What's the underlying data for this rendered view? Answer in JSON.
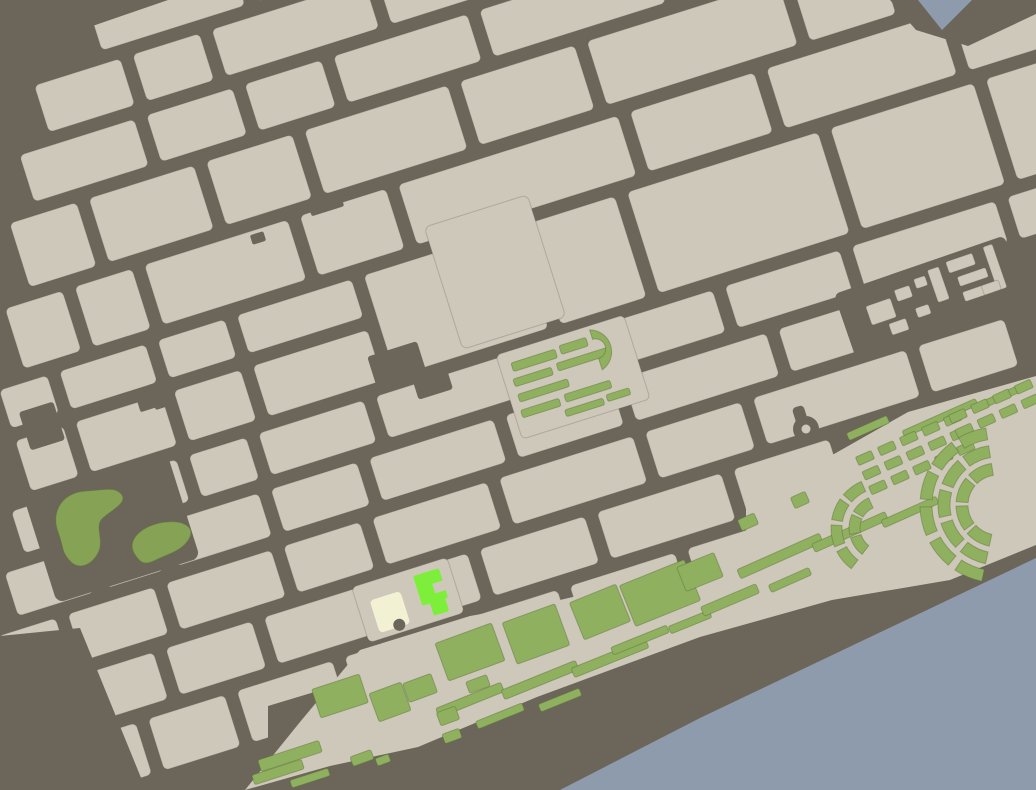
{
  "map": {
    "colors": {
      "ground": "#6C665A",
      "water": "#8E9BAC",
      "block": "#CEC8BB",
      "lawn": "#8FB05F",
      "park": "#86A254",
      "highlight_building": "#7DEF3A",
      "cream_building": "#F2F1D3"
    },
    "features": [
      {
        "name": "river-water"
      },
      {
        "name": "street-grid"
      },
      {
        "name": "city-blocks"
      },
      {
        "name": "park-green"
      },
      {
        "name": "formal-garden-square"
      },
      {
        "name": "waterfront-promenade"
      },
      {
        "name": "garden-fan-arcs"
      },
      {
        "name": "market-block-buildings"
      },
      {
        "name": "roundabout"
      },
      {
        "name": "highlighted-building"
      },
      {
        "name": "landmark-building"
      }
    ]
  }
}
